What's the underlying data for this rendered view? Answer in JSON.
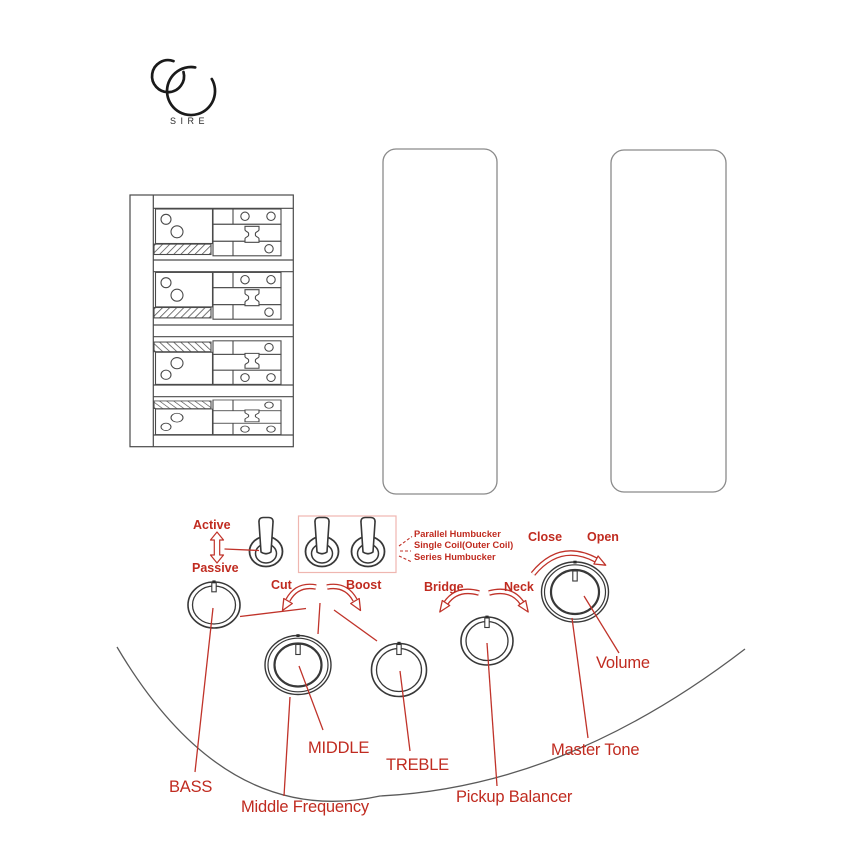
{
  "colors": {
    "accent_red": "#c02b20",
    "highlight_box_pink": "#efb6b0",
    "line_dark": "#3a3a3a",
    "line_gray": "#8a8a8a"
  },
  "logo": {
    "brand": "SIRE"
  },
  "pickup_switches": {
    "active": "Active",
    "passive": "Passive",
    "modes": [
      "Parallel Humbucker",
      "Single Coil(Outer Coil)",
      "Series Humbucker"
    ]
  },
  "eq": {
    "cut": "Cut",
    "boost": "Boost",
    "bass": "BASS",
    "middle": "MIDDLE",
    "treble": "TREBLE",
    "middle_frequency": "Middle Frequency"
  },
  "balance": {
    "bridge": "Bridge",
    "neck": "Neck",
    "pickup_balancer": "Pickup Balancer"
  },
  "volume": {
    "close": "Close",
    "open": "Open",
    "volume": "Volume",
    "master_tone": "Master Tone"
  }
}
